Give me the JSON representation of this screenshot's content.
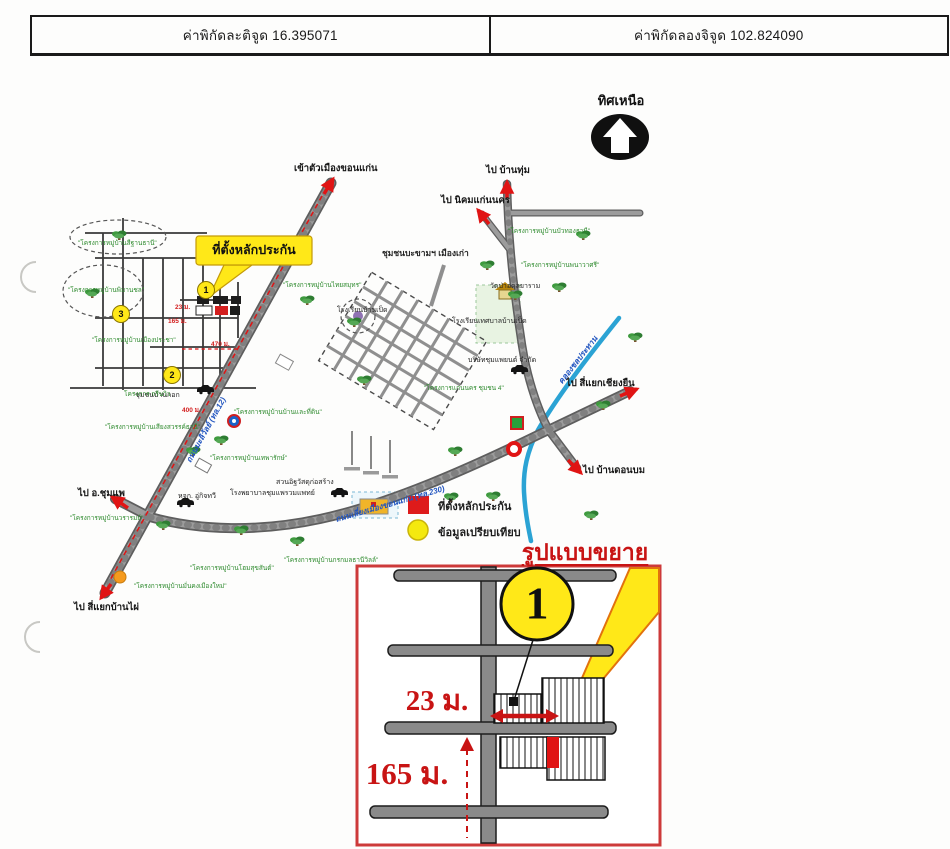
{
  "header": {
    "latitude": "ค่าพิกัดละติจูด 16.395071",
    "longitude": "ค่าพิกัดลองจิจูด 102.824090"
  },
  "compass": {
    "label": "ทิศเหนือ"
  },
  "map": {
    "callout_label": "ที่ตั้งหลักประกัน",
    "community_label": "ชุมชนบะขามฯ เมืองเก่า",
    "directions": [
      {
        "text": "เข้าตัวเมืองขอนแก่น",
        "x": 294,
        "y": 161
      },
      {
        "text": "ไป บ้านทุ่ม",
        "x": 486,
        "y": 163
      },
      {
        "text": "ไป นิคมแก่นนคร",
        "x": 441,
        "y": 193
      },
      {
        "text": "ไป สี่แยกเชียงยืน",
        "x": 566,
        "y": 376
      },
      {
        "text": "ไป บ้านดอนบม",
        "x": 583,
        "y": 463
      },
      {
        "text": "ไป อ.ชุมแพ",
        "x": 78,
        "y": 486
      },
      {
        "text": "ไป สี่แยกบ้านไผ่",
        "x": 74,
        "y": 600
      }
    ],
    "road_labels": [
      {
        "text": "ถนนมะลิวัลย์ (ทล.12)",
        "x": 206,
        "y": 430,
        "rotate": -61,
        "center": true
      },
      {
        "text": "ถนนเลี่ยงเมืองขอนแก่น (ทล.230)",
        "x": 390,
        "y": 504,
        "rotate": -16,
        "center": true
      },
      {
        "text": "คลองชลประทาน",
        "x": 578,
        "y": 360,
        "rotate": -52,
        "center": true
      }
    ],
    "places": [
      {
        "text": "วัดป่าอดุลยาราม",
        "x": 490,
        "y": 281
      },
      {
        "text": "โรงเรียนบ้านเป็ด",
        "x": 337,
        "y": 305
      },
      {
        "text": "โรงเรียนเทศบาลบ้านเป็ด",
        "x": 452,
        "y": 316
      },
      {
        "text": "บริษัทชุมแพยนต์ จำกัด",
        "x": 468,
        "y": 355
      },
      {
        "text": "สวนอิฐวัสดุก่อสร้าง",
        "x": 276,
        "y": 477
      },
      {
        "text": "โรงพยาบาลชุมแพรวมแพทย์",
        "x": 230,
        "y": 488
      },
      {
        "text": "หจก. อู่กิจทวี",
        "x": 178,
        "y": 491
      },
      {
        "text": "ชุมชนบ้านกอก",
        "x": 135,
        "y": 390
      }
    ],
    "projects": [
      {
        "text": "\"โครงการหมู่บ้านสีฐานธานี\"",
        "x": 78,
        "y": 238
      },
      {
        "text": "\"โครงการหมู่บ้านพิมานชล\"",
        "x": 68,
        "y": 285
      },
      {
        "text": "\"โครงการหมู่บ้านเมืองประชา\"",
        "x": 92,
        "y": 335
      },
      {
        "text": "โครงการ กรีนวิว",
        "x": 124,
        "y": 389
      },
      {
        "text": "\"โครงการหมู่บ้านเสียงสวรรค์ธานี\"",
        "x": 105,
        "y": 422
      },
      {
        "text": "\"โครงการหมู่บ้านเทพารักษ์\"",
        "x": 210,
        "y": 453
      },
      {
        "text": "\"โครงการหมู่บ้านบ้านและที่ดิน\"",
        "x": 234,
        "y": 407
      },
      {
        "text": "\"โครงการหมู่บ้านไทยสมุทร\"",
        "x": 283,
        "y": 280
      },
      {
        "text": "\"โครงการหมู่บ้านบัวทองธานี\"",
        "x": 508,
        "y": 226
      },
      {
        "text": "\"โครงการหมู่บ้านพนาวาศรี\"",
        "x": 521,
        "y": 260
      },
      {
        "text": "\"โครงการแก่นนคร ชุมชน 4\"",
        "x": 424,
        "y": 383
      },
      {
        "text": "\"โครงการหมู่บ้านโฮมสุขสันต์\"",
        "x": 190,
        "y": 563
      },
      {
        "text": "\"โครงการหมู่บ้านมั่นคงเมืองใหม่\"",
        "x": 134,
        "y": 581
      },
      {
        "text": "\"โครงการหมู่บ้านกรกมลธานีวิลล์\"",
        "x": 284,
        "y": 555
      },
      {
        "text": "\"โครงการหมู่บ้านวรารมย์\"",
        "x": 70,
        "y": 513
      }
    ],
    "measurements": [
      {
        "text": "23 ม.",
        "x": 175,
        "y": 302
      },
      {
        "text": "165 ม.",
        "x": 168,
        "y": 316
      },
      {
        "text": "470 ม.",
        "x": 211,
        "y": 339
      },
      {
        "text": "400 ม.",
        "x": 182,
        "y": 405
      }
    ],
    "markers": [
      {
        "text": "1",
        "x": 206,
        "y": 290,
        "center": true
      },
      {
        "text": "2",
        "x": 172,
        "y": 375,
        "center": true
      },
      {
        "text": "3",
        "x": 121,
        "y": 314,
        "center": true
      }
    ]
  },
  "legend": {
    "items": [
      {
        "symbol": "red-square",
        "label": "ที่ตั้งหลักประกัน"
      },
      {
        "symbol": "yellow-circle",
        "label": "ข้อมูลเปรียบเทียบ"
      }
    ]
  },
  "inset": {
    "title": "รูปแบบขยาย",
    "marker": "1",
    "width_text": "23 ม.",
    "distance_text": "165 ม."
  },
  "colors": {
    "arrow_red": "#e01414",
    "measure_red": "#c81414",
    "callout_yellow": "#ffe818",
    "project_green": "#2f8b2f",
    "road_gray": "#9c9c9c",
    "canal_blue": "#2ba3d4",
    "road_text_blue": "#2356c0"
  }
}
